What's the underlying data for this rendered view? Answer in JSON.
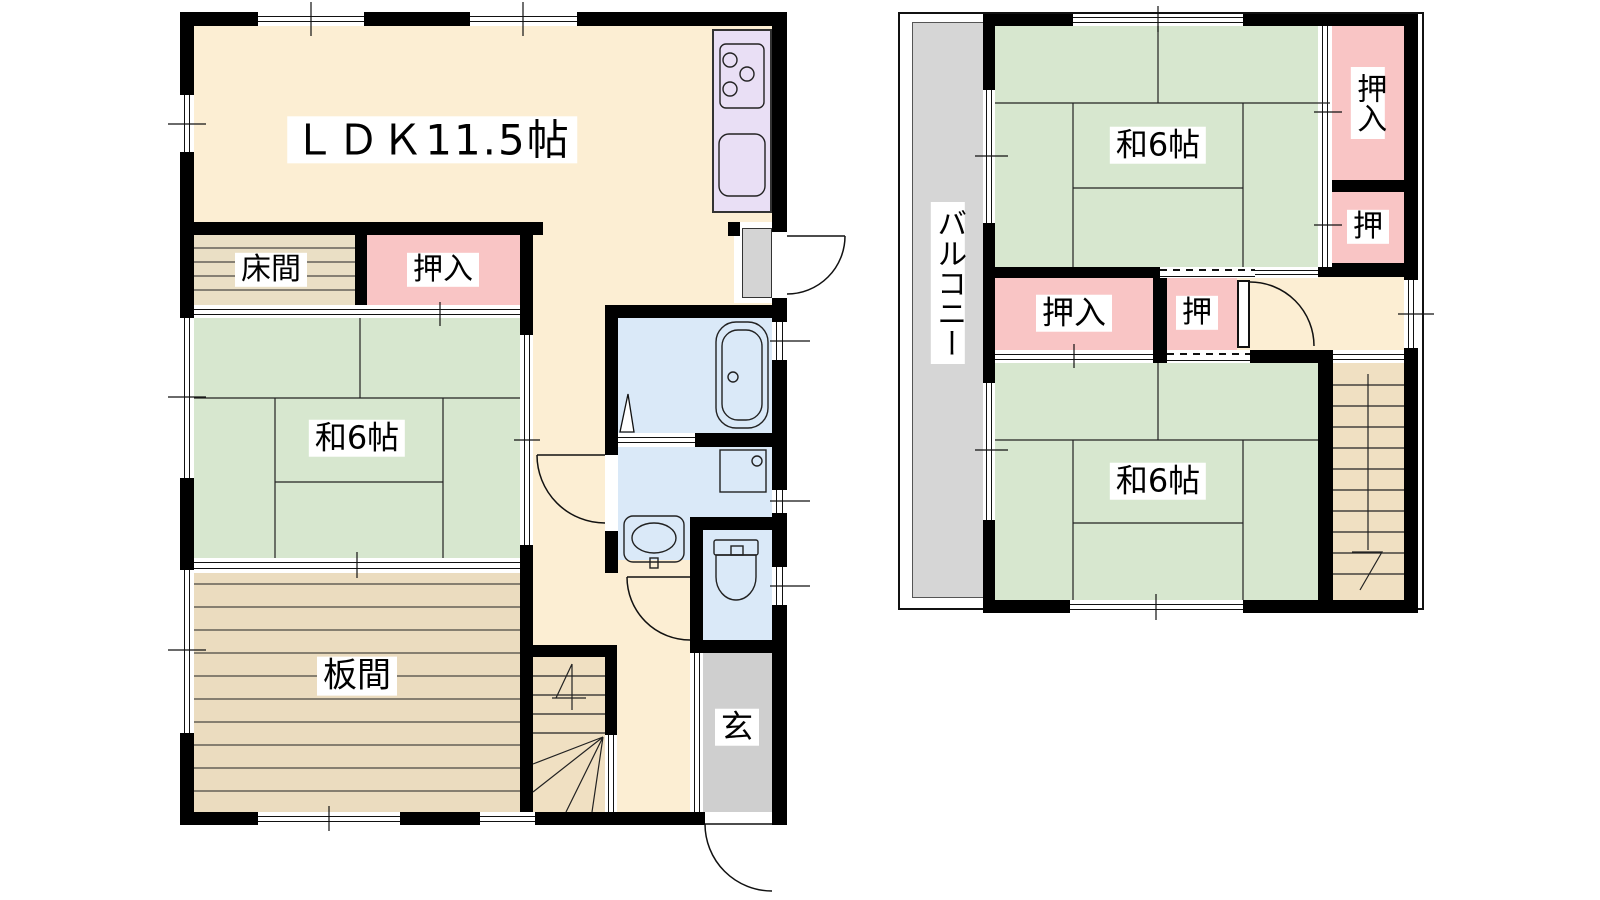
{
  "floors": {
    "first": {
      "ldk_label": "ＬＤＫ11.5帖",
      "tokonoma_label": "床間",
      "oshiire_label": "押入",
      "washitsu_label": "和6帖",
      "itanoma_label": "板間",
      "genkan_label": "玄"
    },
    "second": {
      "balcony_label": "バルコニー",
      "washitsu_top_label": "和6帖",
      "oshiire_top_right_label": "押入",
      "oshi_right_label": "押",
      "oshiire_mid_label": "押入",
      "oshi_mid_label": "押",
      "washitsu_bottom_label": "和6帖"
    }
  },
  "colors": {
    "wall": "#000000",
    "floor_cream": "#FCEED3",
    "tatami_green": "#D7E7CF",
    "closet_pink": "#F9C5C5",
    "wood_tan": "#EBDCBF",
    "tokonoma_tan": "#EADFC5",
    "stair_tan": "#F0E0C2",
    "kitchen_purple": "#E9DFF5",
    "water_blue": "#DAE9F8",
    "genkan_gray": "#CFCFCF",
    "balcony_gray": "#D6D6D6"
  }
}
